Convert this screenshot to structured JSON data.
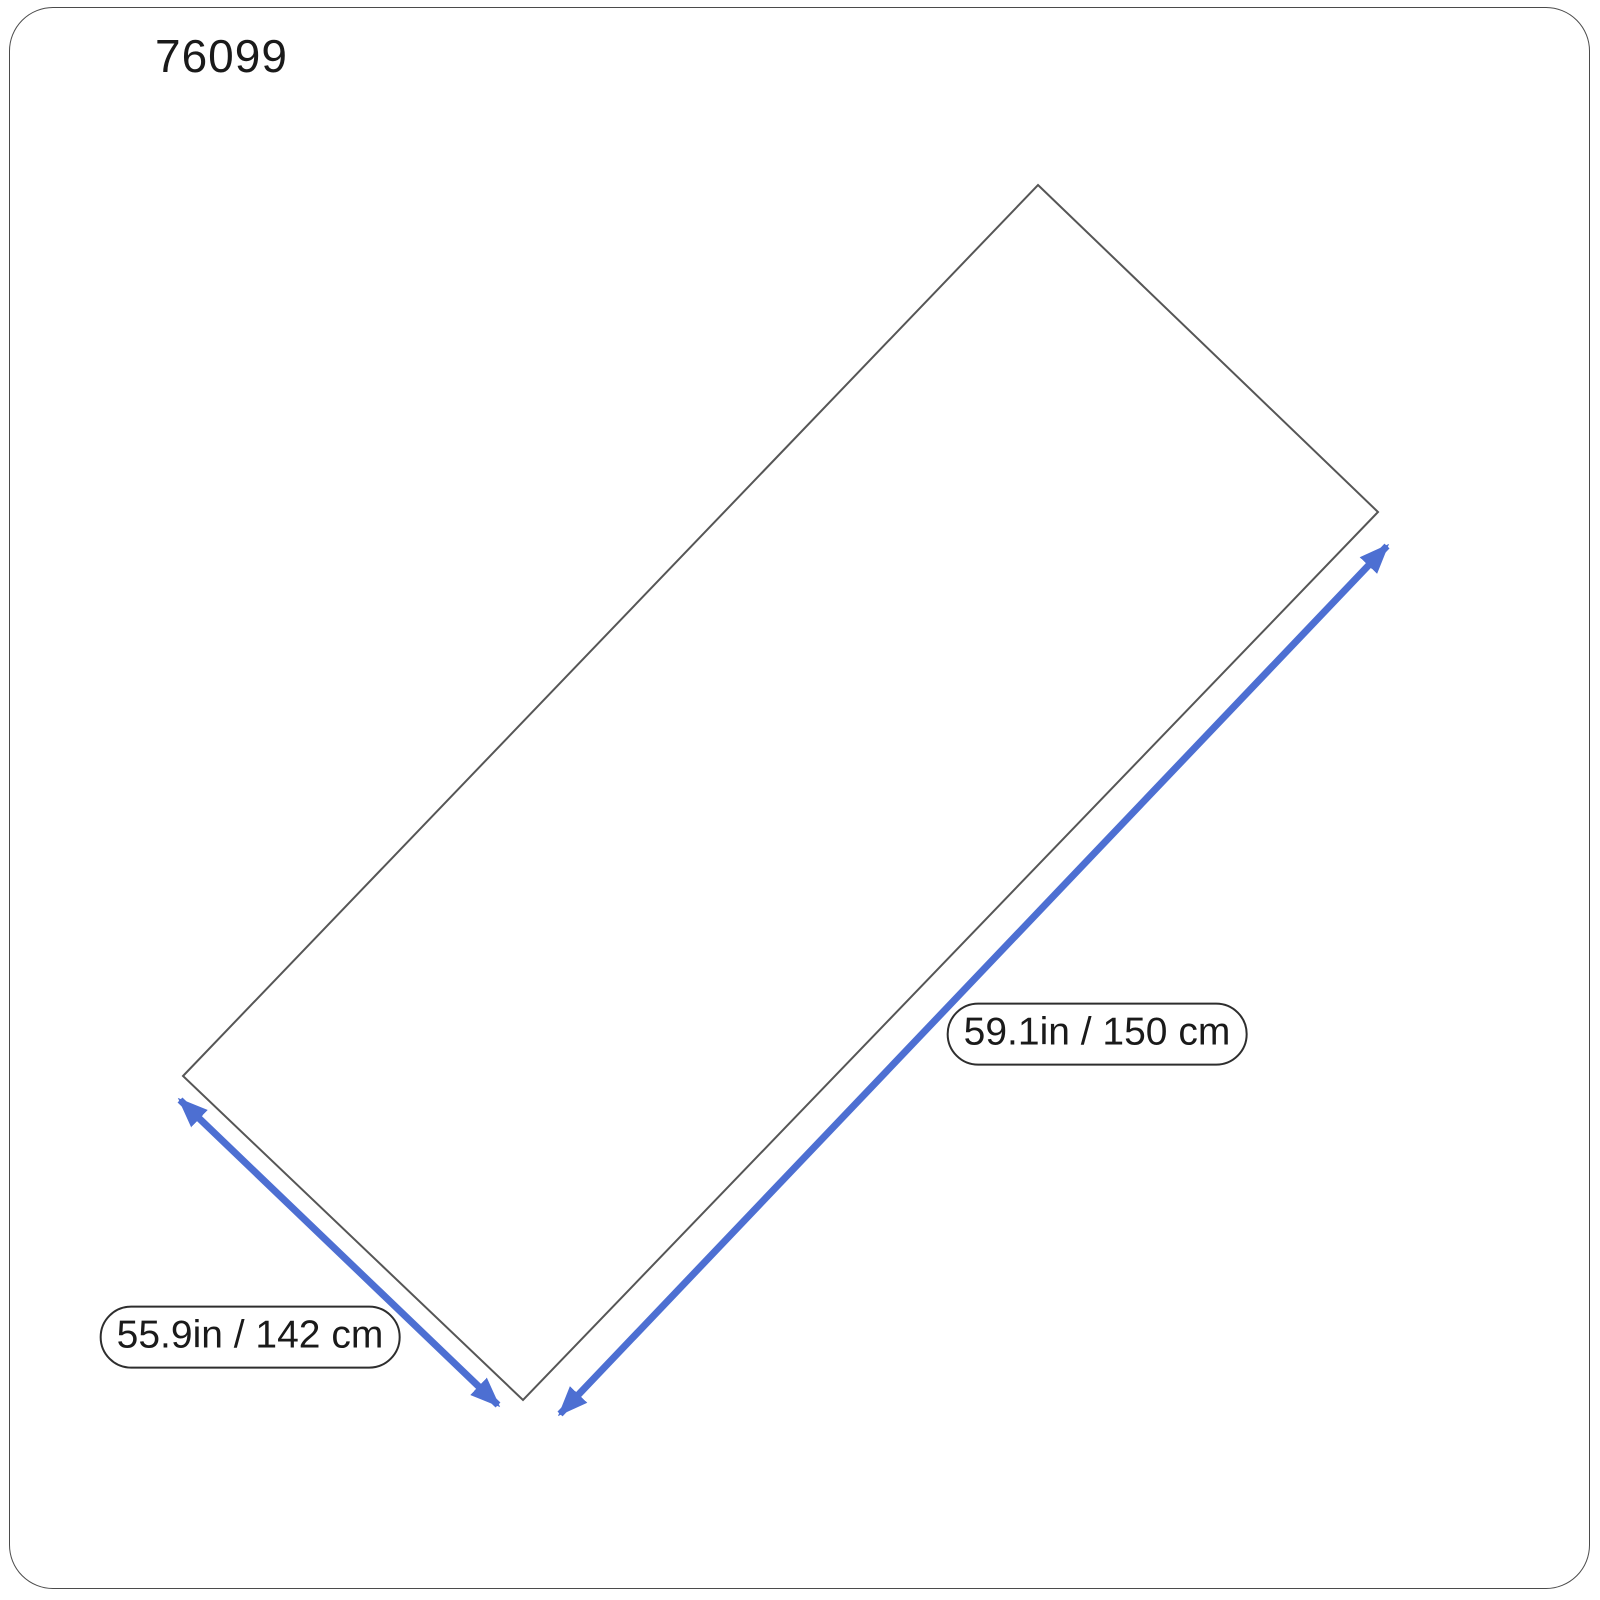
{
  "title": "76099",
  "colors": {
    "background": "#ffffff",
    "frame_border": "#4b4b4b",
    "outline": "#565656",
    "accent_arrow": "#4d6fd2",
    "label_border": "#2e2e2e",
    "text": "#1a1a1a"
  },
  "diagram": {
    "shape": "rotated-rectangle",
    "labels": {
      "long_side": "59.1in / 150 cm",
      "short_side": "55.9in / 142 cm"
    }
  }
}
